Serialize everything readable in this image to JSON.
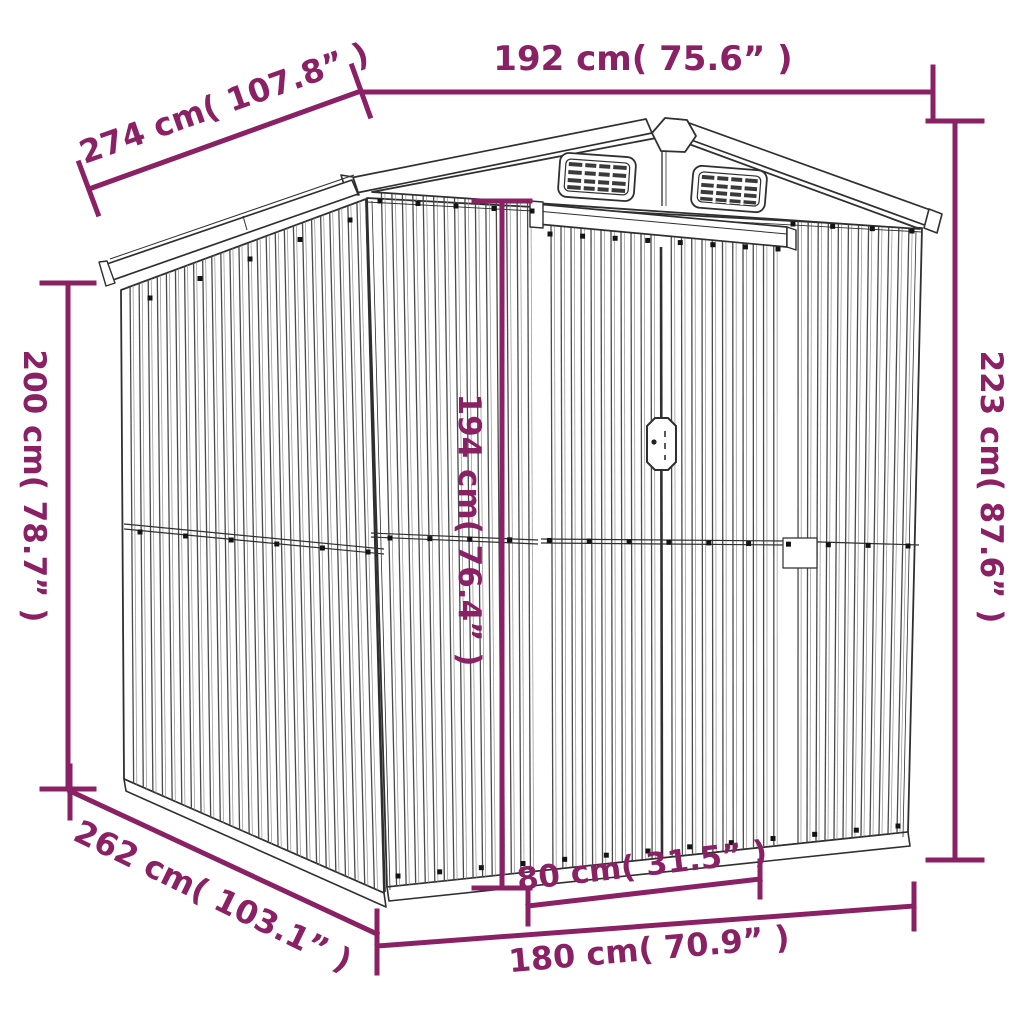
{
  "figure": {
    "type": "product-dimension-diagram",
    "subject": "metal garden shed line drawing with sliding doors, gable roof and two louver vents"
  },
  "colors": {
    "dimension": "#8a2164",
    "line_art": "#2f2f2f",
    "background": "#ffffff"
  },
  "dimensions": {
    "width_top": {
      "text": "192 cm( 75.6” )",
      "cm": 192,
      "inches": 75.6,
      "measures": "roof width"
    },
    "depth_roof": {
      "text": "274 cm( 107.8” )",
      "cm": 274,
      "inches": 107.8,
      "measures": "roof depth"
    },
    "height_left": {
      "text": "200 cm( 78.7” )",
      "cm": 200,
      "inches": 78.7,
      "measures": "wall height"
    },
    "height_right": {
      "text": "223 cm( 87.6” )",
      "cm": 223,
      "inches": 87.6,
      "measures": "total height"
    },
    "height_door": {
      "text": "194 cm( 76.4” )",
      "cm": 194,
      "inches": 76.4,
      "measures": "door height"
    },
    "depth_base": {
      "text": "262 cm( 103.1” )",
      "cm": 262,
      "inches": 103.1,
      "measures": "base depth"
    },
    "door_width": {
      "text": "80 cm( 31.5” )",
      "cm": 80,
      "inches": 31.5,
      "measures": "door width"
    },
    "width_base": {
      "text": "180 cm( 70.9” )",
      "cm": 180,
      "inches": 70.9,
      "measures": "base width"
    }
  }
}
